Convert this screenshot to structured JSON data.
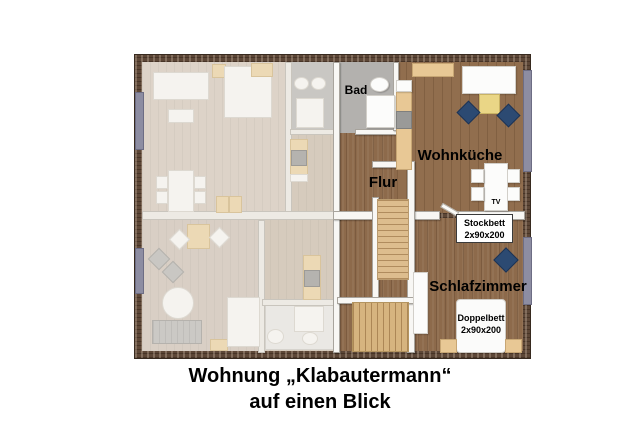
{
  "title": {
    "line1": "Wohnung „Klabautermann“",
    "line2": "auf einen Blick"
  },
  "room_labels": {
    "bad": "Bad",
    "wohnkueche": "Wohnküche",
    "flur": "Flur",
    "schlafzimmer": "Schlafzimmer"
  },
  "furniture_labels": {
    "stockbett_title": "Stockbett",
    "stockbett_size": "2x90x200",
    "doppelbett_title": "Doppelbett",
    "doppelbett_size": "2x90x200",
    "tv": "TV"
  },
  "colors": {
    "wood_floor": "#8d6a4b",
    "faded_floor": "#d9cfc4",
    "bad_floor": "#b3b1ae",
    "brick_wall": "#5d4737",
    "chair_blue": "#2c4a72",
    "table_yellow": "#ead686",
    "stair_wood": "#ddbd8e",
    "window": "#8d8da2"
  }
}
